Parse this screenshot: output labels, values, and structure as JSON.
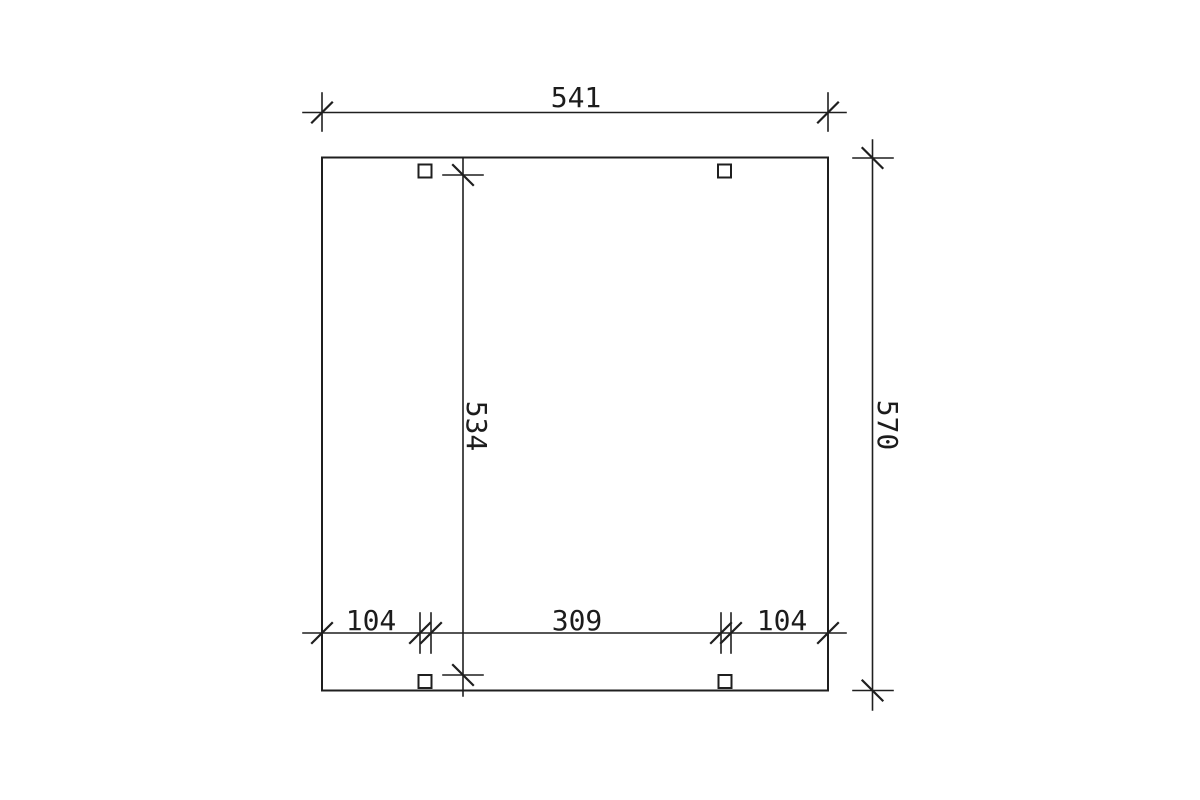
{
  "drawing": {
    "description": "Dimensioned plan view of a rectangular structure with two intermediate posts at front and back",
    "background_color": "#ffffff",
    "line_color": "#1f1f1f",
    "dimensions": {
      "overall_width": {
        "label": "541",
        "value": 541,
        "orientation": "horizontal",
        "position": "top"
      },
      "overall_depth": {
        "label": "570",
        "value": 570,
        "orientation": "vertical",
        "position": "right"
      },
      "inner_depth": {
        "label": "534",
        "value": 534,
        "orientation": "vertical",
        "position": "inner"
      },
      "bottom_left_offset": {
        "label": "104",
        "value": 104,
        "orientation": "horizontal",
        "position": "bottom-left"
      },
      "bottom_center_span": {
        "label": "309",
        "value": 309,
        "orientation": "horizontal",
        "position": "bottom-center"
      },
      "bottom_right_offset": {
        "label": "104",
        "value": 104,
        "orientation": "horizontal",
        "position": "bottom-right"
      }
    },
    "posts_count": 4
  }
}
